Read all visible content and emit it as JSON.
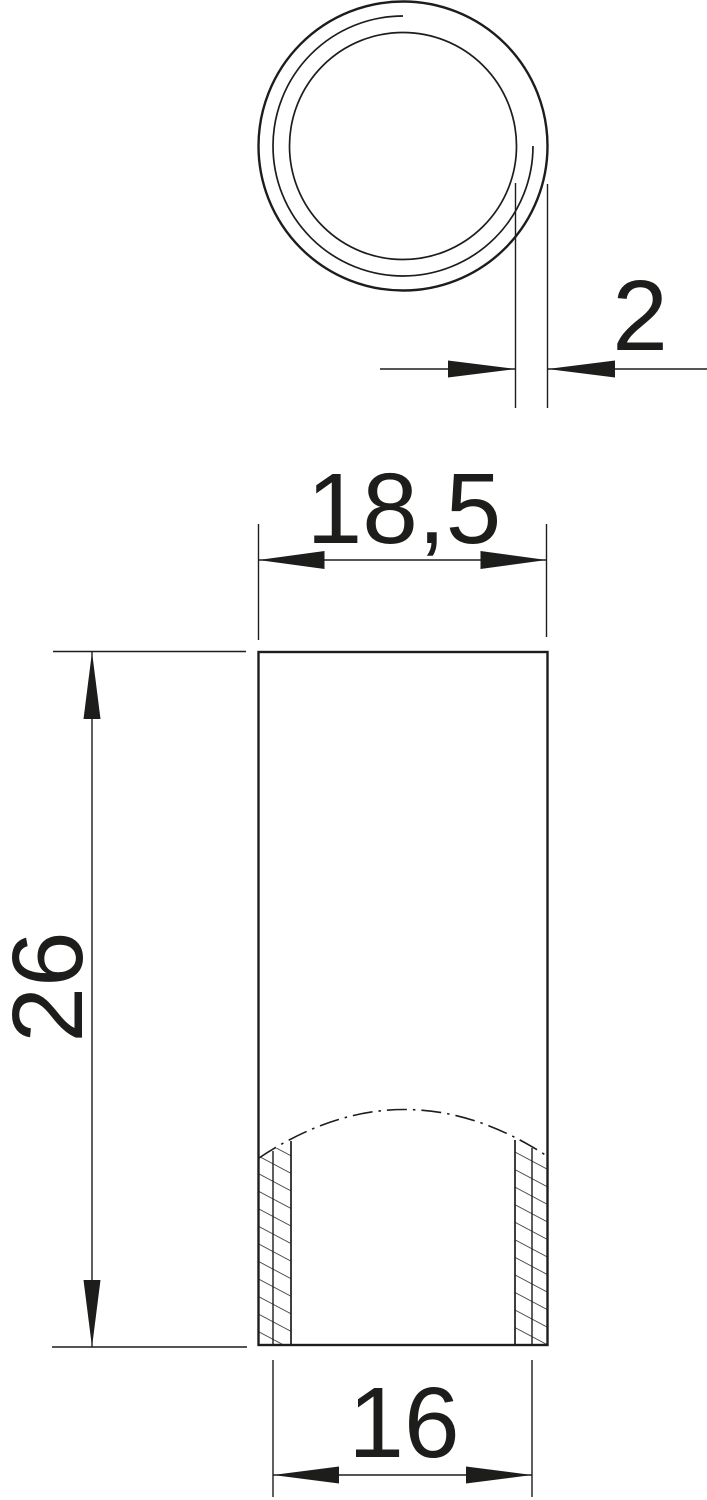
{
  "drawing": {
    "type": "technical-drawing-threaded-sleeve",
    "colors": {
      "background": "#ffffff",
      "line": "#1d1d1b"
    },
    "dimensions": {
      "wall_thickness": {
        "label": "2"
      },
      "outer_diameter": {
        "label": "18,5"
      },
      "length": {
        "label": "26"
      },
      "inner_diameter": {
        "label": "16"
      }
    }
  }
}
